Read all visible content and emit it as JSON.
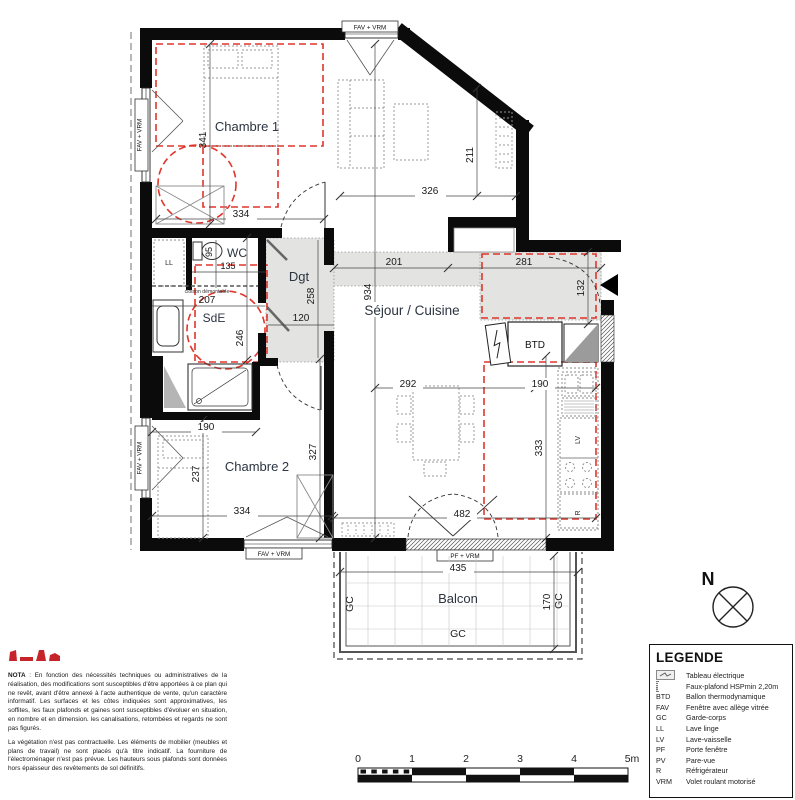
{
  "plan": {
    "rooms": {
      "chambre1": "Chambre 1",
      "chambre2": "Chambre 2",
      "wc": "WC",
      "sde": "SdE",
      "dgt": "Dgt",
      "sejour": "Séjour / Cuisine",
      "balcon": "Balcon"
    },
    "annotations": {
      "fav_vrm": "FAV + VRM",
      "pf_vrm": "PF + VRM",
      "cloison": "cloison démontable",
      "ll": "LL",
      "lv": "LV",
      "r": "R",
      "btd": "BTD",
      "gc": "GC"
    },
    "dims": {
      "ch1_h": "341",
      "ch1_w": "334",
      "sej_top_w": "326",
      "sej_top_h": "211",
      "wc_d": "95",
      "wc_w": "135",
      "sde_w": "207",
      "sde_h": "246",
      "dgt_h": "258",
      "dgt_open": "120",
      "entry_w1": "201",
      "entry_w2": "281",
      "entry_d": "132",
      "sej_h": "934",
      "sej_w1": "292",
      "sej_w2": "190",
      "kit_h": "333",
      "sej_bot_w": "482",
      "ch2_top_w": "190",
      "ch2_l": "237",
      "ch2_r": "327",
      "ch2_w": "334",
      "balc_w": "435",
      "balc_h": "170"
    }
  },
  "north": {
    "label": "N"
  },
  "scale_bar": {
    "ticks": [
      "0",
      "1",
      "2",
      "3",
      "4",
      "5m"
    ]
  },
  "nota": {
    "title": "NOTA",
    "p1": " : En fonction des nécessités techniques ou administratives de la réalisation, des modifications sont susceptibles d'être apportées à ce plan qui ne revêt, avant d'être annexé à l'acte authentique de vente, qu'un caractère informatif. Les surfaces et les côtes indiquées sont approximatives, les soffites, les faux plafonds et gaines sont susceptibles d'évoluer en situation, en nombre et en dimension. les canalisations, retombées et regards ne sont pas figurés.",
    "p2": "La végétation n'est pas contractuelle. Les éléments de mobilier (meubles et plans de travail) ne sont placés qu'à titre indicatif. La fourniture de l'électroménager n'est pas prévue. Les hauteurs sous plafonds sont données hors épaisseur des revêtements de sol définitifs."
  },
  "legend": {
    "title": "LEGENDE",
    "items": [
      {
        "abbr": "",
        "label": "Tableau électrique"
      },
      {
        "abbr": "",
        "label": "Faux-plafond HSPmin 2,20m"
      },
      {
        "abbr": "BTD",
        "label": "Ballon thermodynamique"
      },
      {
        "abbr": "FAV",
        "label": "Fenêtre avec allège vitrée"
      },
      {
        "abbr": "GC",
        "label": "Garde-corps"
      },
      {
        "abbr": "LL",
        "label": "Lave linge"
      },
      {
        "abbr": "LV",
        "label": "Lave-vaisselle"
      },
      {
        "abbr": "PF",
        "label": "Porte fenêtre"
      },
      {
        "abbr": "PV",
        "label": "Pare-vue"
      },
      {
        "abbr": "R",
        "label": "Réfrigérateur"
      },
      {
        "abbr": "VRM",
        "label": "Volet roulant motorisé"
      }
    ]
  },
  "colors": {
    "wall": "#0b0b0b",
    "faux_plafond_red": "#e0352b",
    "soffit_gray": "#e3e3e2",
    "logo_red": "#c5242b"
  }
}
